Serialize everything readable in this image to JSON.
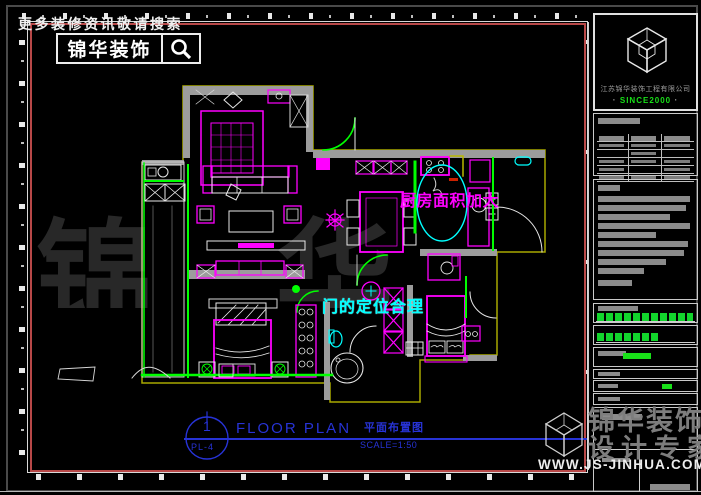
{
  "header": {
    "tagline": "更多装修资讯敬请搜索",
    "search_box_label": "锦华装饰"
  },
  "logo_box": {
    "company_name": "江苏锦华装饰工程有限公司",
    "since_text": "SINCE2000",
    "dot": "·"
  },
  "plan_annotations": {
    "kitchen_note": "厨房面积加大",
    "door_note": "门的定位合理"
  },
  "title_bar": {
    "sheet_number": "1",
    "sheet_code": "PL-4",
    "title_en": "FLOOR PLAN",
    "title_cn": "平面布置图",
    "scale_text": "SCALE=1:50"
  },
  "watermarks": {
    "center_text": "锦 华 装 饰",
    "corner_line1": "锦华装饰",
    "corner_line2": "设计专家",
    "website": "WWW.JS-JINHUA.COM"
  },
  "colors": {
    "frame_red": "#b84848",
    "cad_magenta": "#ff00ff",
    "cad_green": "#00ff00",
    "cad_cyan": "#00ffff",
    "cad_yellow": "#b9b900",
    "cad_blue": "#2733d6",
    "wall_gray": "#9c9c9c"
  }
}
